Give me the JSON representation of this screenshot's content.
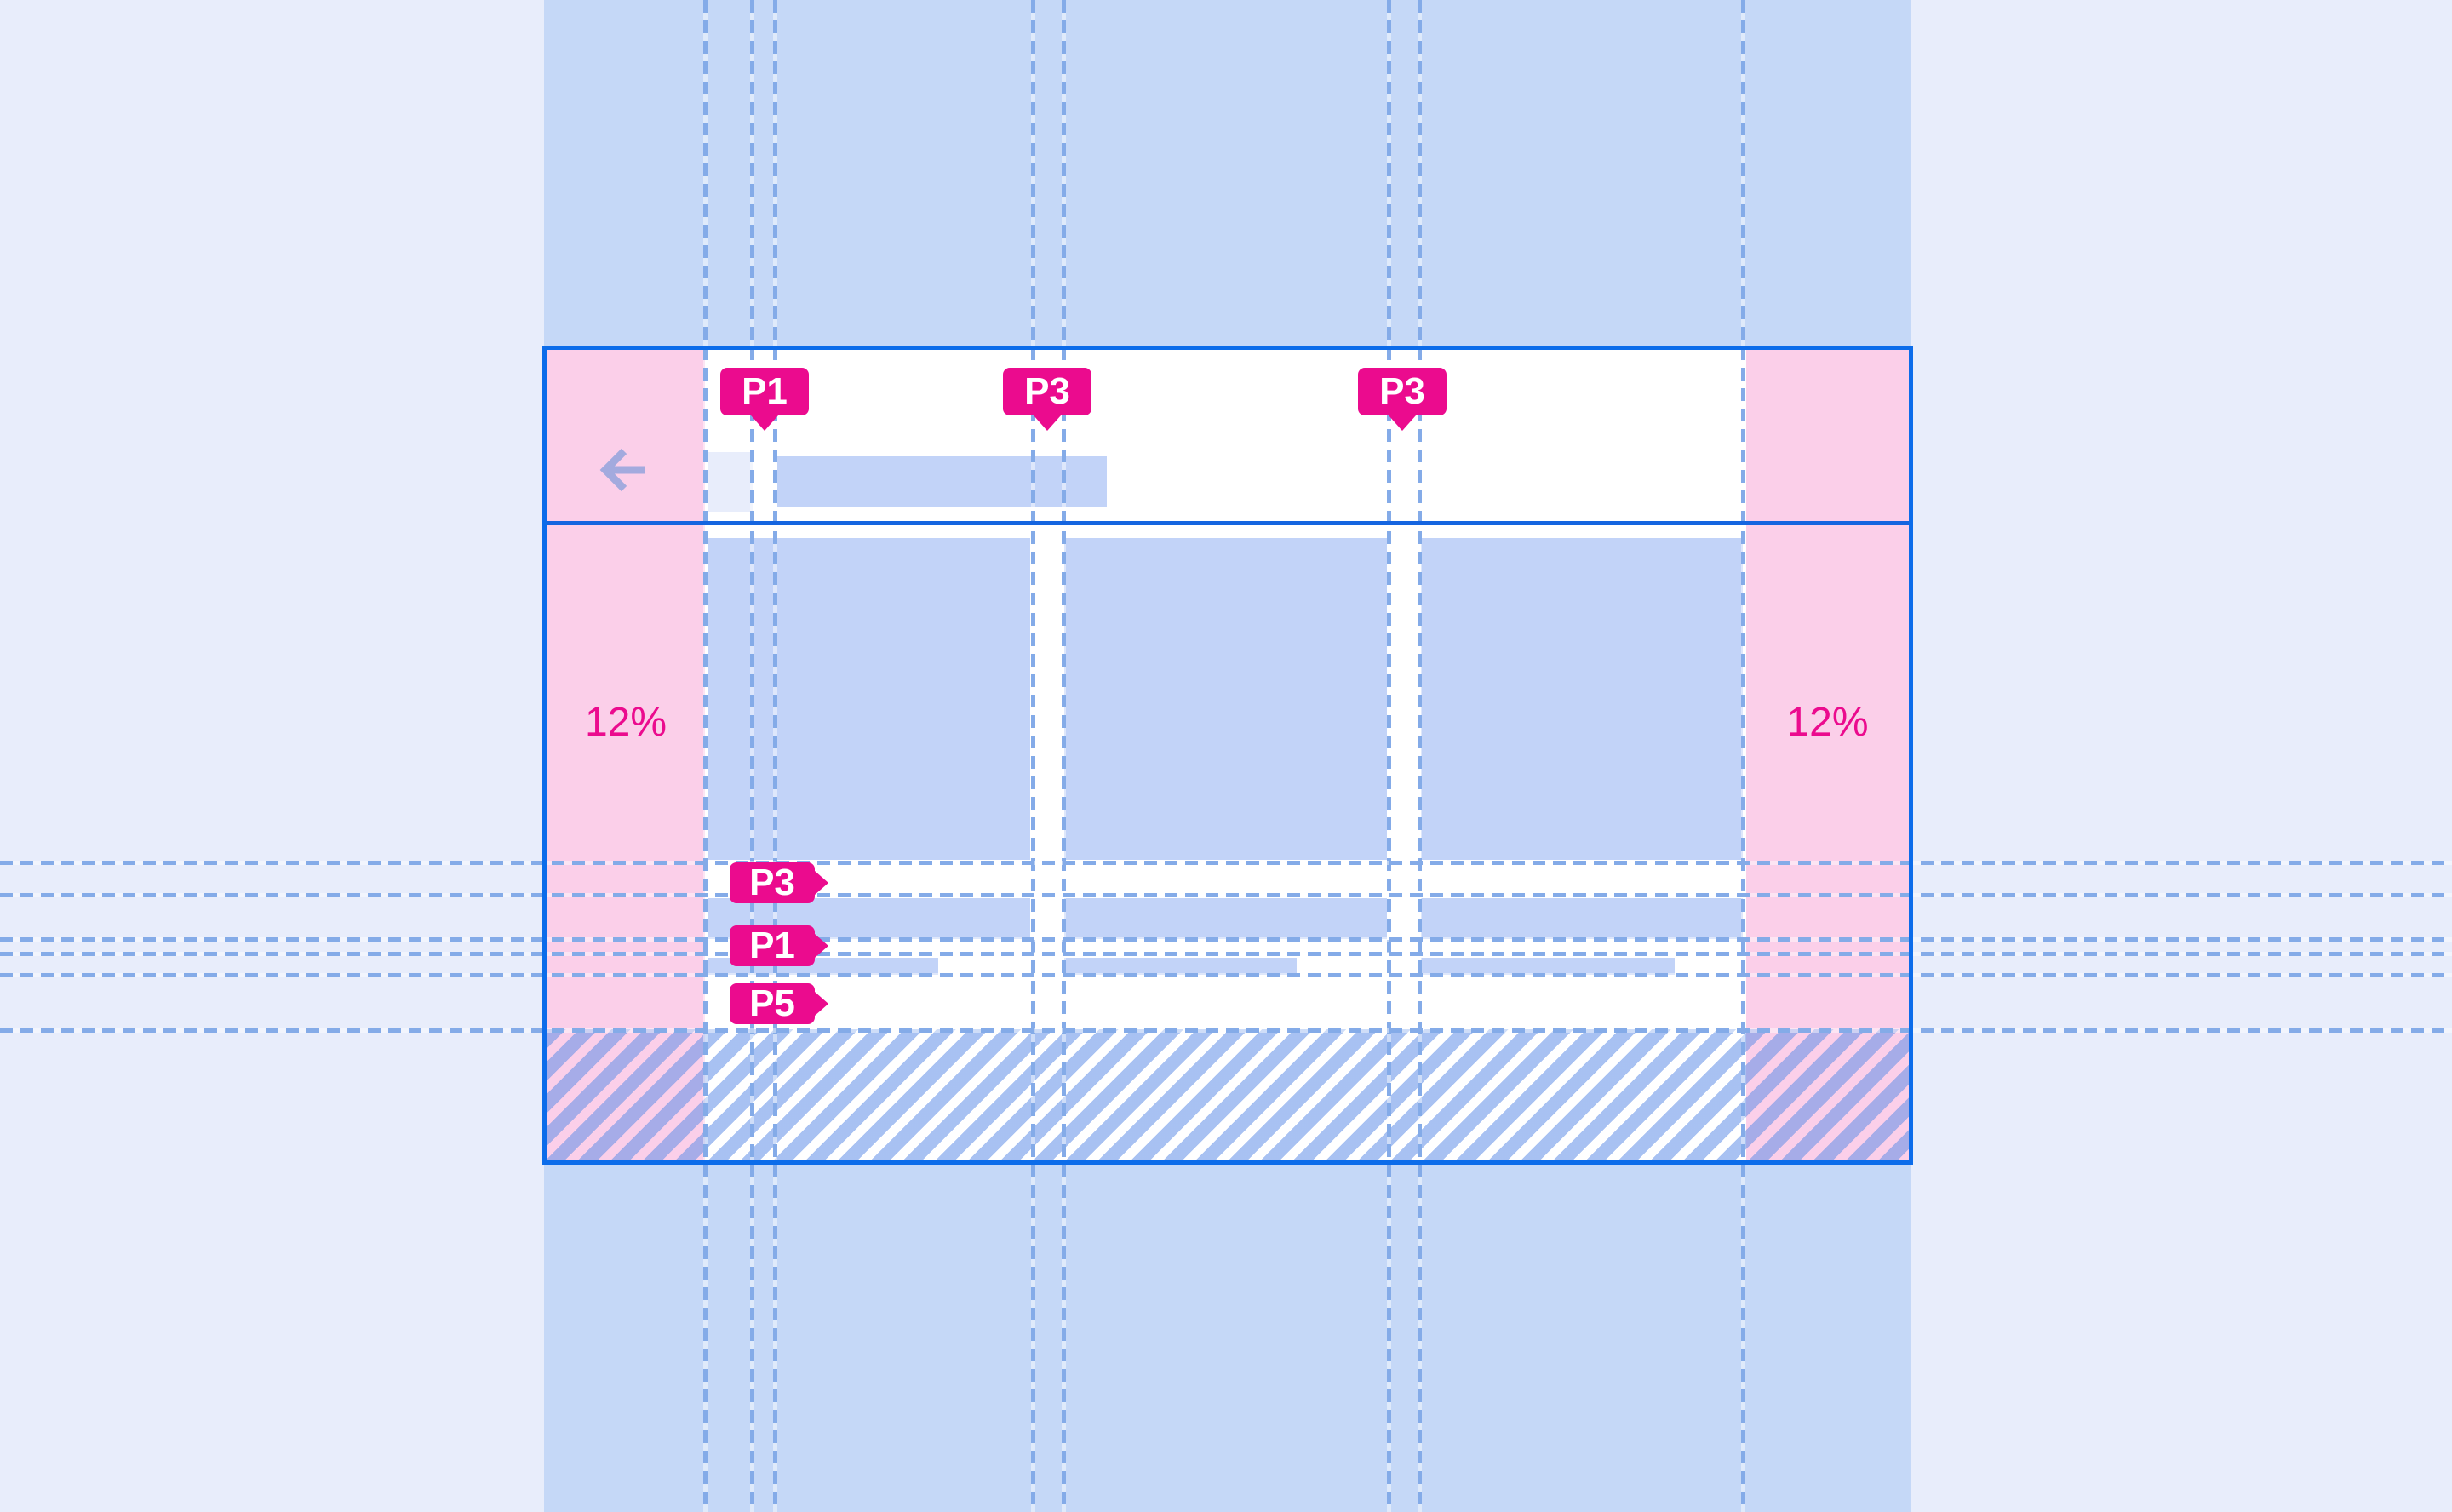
{
  "meta": {
    "description": "Responsive layout spacing specification mockup: app screen with 12% side margins, three-column grid, and padding annotations"
  },
  "colors": {
    "outer_bg": "#e8edfb",
    "band": "#c5d8f7",
    "card_bg": "#ffffff",
    "card_border": "#0c6cea",
    "divider": "#1565e0",
    "pink_margin": "#fbcfe9",
    "magenta": "#eb0b8e",
    "tag_text": "#ffffff",
    "placeholder_blue": "#c2d3f8",
    "square_light": "#e8edfb",
    "guide_blue": "#84abe8",
    "guide_gap": "rgba(255,255,255,0.45)",
    "arrow": "#a3aade",
    "hatch_stripe": "rgba(99,145,232,0.56)"
  },
  "annotations": {
    "top_tags": [
      {
        "text": "P1"
      },
      {
        "text": "P3"
      },
      {
        "text": "P3"
      }
    ],
    "side_tags": [
      {
        "text": "P3"
      },
      {
        "text": "P1"
      },
      {
        "text": "P5"
      }
    ],
    "margin_left": {
      "text": "12%"
    },
    "margin_right": {
      "text": "12%"
    }
  },
  "header": {
    "back_icon": "arrow-left"
  }
}
